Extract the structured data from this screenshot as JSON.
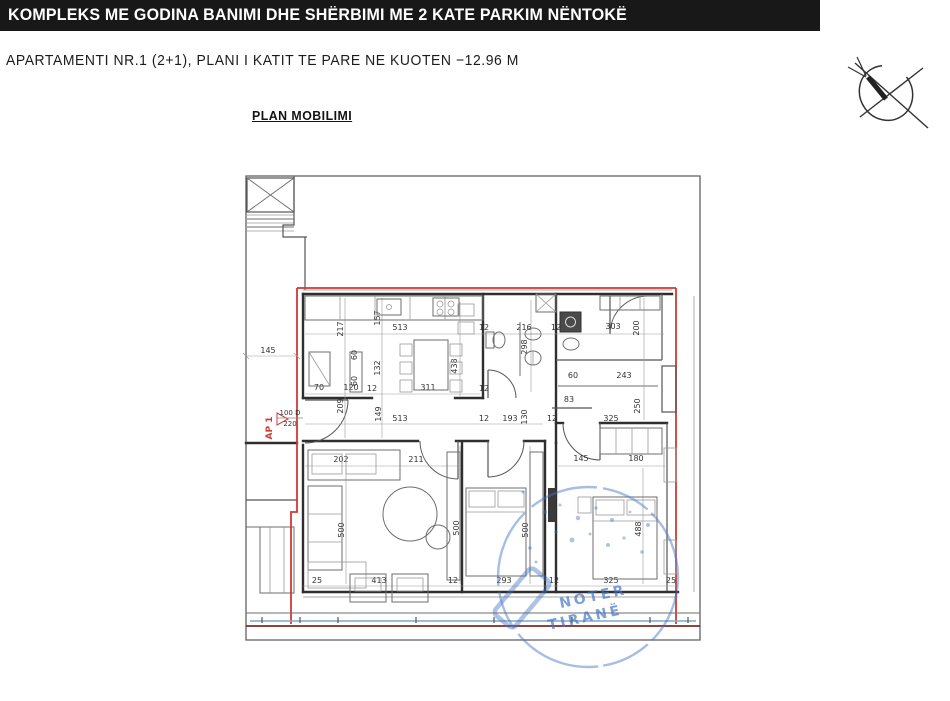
{
  "header": {
    "title": "KOMPLEKS ME GODINA BANIMI DHE SHËRBIMI  ME 2 KATE PARKIM NËNTOKË"
  },
  "subtitle": "APARTAMENTI NR.1 (2+1), PLANI I KATIT TE PARE NE KUOTEN −12.96 M",
  "plan_label": "PLAN MOBILIMI",
  "entrance": {
    "tag": "AP 1",
    "door_width": "100 D",
    "door_height": "220"
  },
  "stamp": {
    "line1": "NOTER",
    "line2": "TIRANË"
  },
  "colors": {
    "boundary_red": "#cf3a32",
    "stamp_blue": "#4272c4",
    "balcony_blue": "#7fa8c9",
    "bottom_brown": "#7b2b26"
  },
  "plan": {
    "dimensions": [
      {
        "t": "145",
        "x": 268,
        "y": 353,
        "r": 0
      },
      {
        "t": "217",
        "x": 343,
        "y": 329,
        "r": -90
      },
      {
        "t": "157",
        "x": 380,
        "y": 318,
        "r": -90
      },
      {
        "t": "513",
        "x": 400,
        "y": 330,
        "r": 0
      },
      {
        "t": "12",
        "x": 484,
        "y": 330,
        "r": 0
      },
      {
        "t": "216",
        "x": 524,
        "y": 330,
        "r": 0
      },
      {
        "t": "12",
        "x": 556,
        "y": 330,
        "r": 0
      },
      {
        "t": "298",
        "x": 527,
        "y": 347,
        "r": -90
      },
      {
        "t": "303",
        "x": 613,
        "y": 329,
        "r": 0
      },
      {
        "t": "200",
        "x": 639,
        "y": 328,
        "r": -90
      },
      {
        "t": "60",
        "x": 357,
        "y": 355,
        "r": -90
      },
      {
        "t": "60",
        "x": 357,
        "y": 381,
        "r": -90
      },
      {
        "t": "132",
        "x": 380,
        "y": 368,
        "r": -90
      },
      {
        "t": "438",
        "x": 457,
        "y": 366,
        "r": -90
      },
      {
        "t": "70",
        "x": 319,
        "y": 390,
        "r": 0
      },
      {
        "t": "120",
        "x": 351,
        "y": 390,
        "r": 0
      },
      {
        "t": "12",
        "x": 372,
        "y": 391,
        "r": 0
      },
      {
        "t": "311",
        "x": 428,
        "y": 390,
        "r": 0
      },
      {
        "t": "12",
        "x": 484,
        "y": 391,
        "r": 0
      },
      {
        "t": "209",
        "x": 343,
        "y": 406,
        "r": -90
      },
      {
        "t": "149",
        "x": 381,
        "y": 414,
        "r": -90
      },
      {
        "t": "513",
        "x": 400,
        "y": 421,
        "r": 0
      },
      {
        "t": "60",
        "x": 573,
        "y": 378,
        "r": 0
      },
      {
        "t": "243",
        "x": 624,
        "y": 378,
        "r": 0
      },
      {
        "t": "83",
        "x": 569,
        "y": 402,
        "r": 0
      },
      {
        "t": "250",
        "x": 640,
        "y": 406,
        "r": -90
      },
      {
        "t": "12",
        "x": 484,
        "y": 421,
        "r": 0
      },
      {
        "t": "193",
        "x": 510,
        "y": 421,
        "r": 0
      },
      {
        "t": "130",
        "x": 527,
        "y": 417,
        "r": -90
      },
      {
        "t": "12",
        "x": 552,
        "y": 421,
        "r": 0
      },
      {
        "t": "325",
        "x": 611,
        "y": 421,
        "r": 0
      },
      {
        "t": "202",
        "x": 341,
        "y": 462,
        "r": 0
      },
      {
        "t": "211",
        "x": 416,
        "y": 462,
        "r": 0
      },
      {
        "t": "145",
        "x": 581,
        "y": 461,
        "r": 0
      },
      {
        "t": "180",
        "x": 636,
        "y": 461,
        "r": 0
      },
      {
        "t": "500",
        "x": 344,
        "y": 530,
        "r": -90
      },
      {
        "t": "500",
        "x": 459,
        "y": 528,
        "r": -90
      },
      {
        "t": "500",
        "x": 528,
        "y": 530,
        "r": -90
      },
      {
        "t": "488",
        "x": 641,
        "y": 529,
        "r": -90
      },
      {
        "t": "25",
        "x": 317,
        "y": 583,
        "r": 0
      },
      {
        "t": "413",
        "x": 379,
        "y": 583,
        "r": 0
      },
      {
        "t": "12",
        "x": 453,
        "y": 583,
        "r": 0
      },
      {
        "t": "293",
        "x": 504,
        "y": 583,
        "r": 0
      },
      {
        "t": "12",
        "x": 554,
        "y": 583,
        "r": 0
      },
      {
        "t": "325",
        "x": 611,
        "y": 583,
        "r": 0
      },
      {
        "t": "25",
        "x": 671,
        "y": 583,
        "r": 0
      }
    ]
  }
}
